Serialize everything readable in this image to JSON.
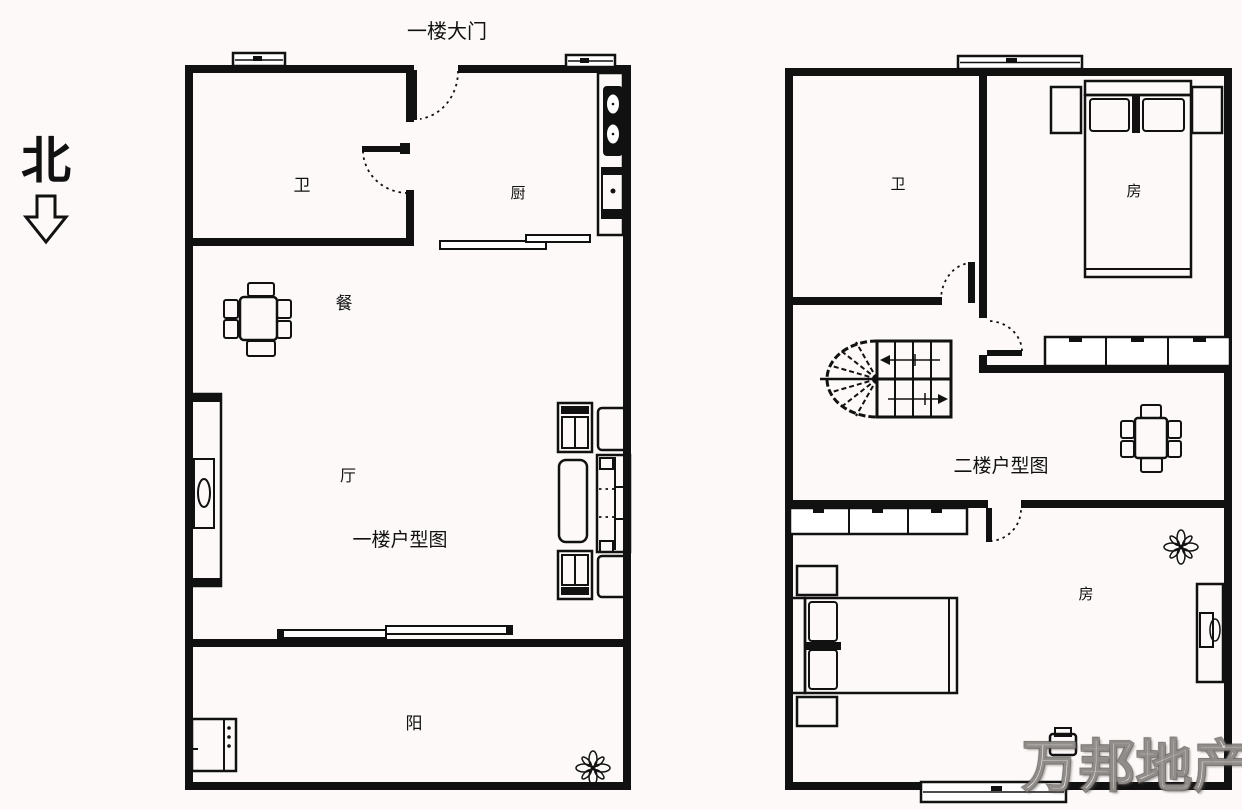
{
  "page": {
    "background": "#fcf9f8",
    "line_color": "#111111",
    "watermark_color": "#b9b3ae"
  },
  "north_indicator": {
    "label": "北"
  },
  "entrance": {
    "label": "一楼大门"
  },
  "floor1": {
    "title": "一楼户型图",
    "rooms": {
      "bathroom": "卫",
      "kitchen": "厨",
      "dining": "餐",
      "living": "厅",
      "balcony": "阳"
    }
  },
  "floor2": {
    "title": "二楼户型图",
    "rooms": {
      "bathroom": "卫",
      "bedroom_top": "房",
      "bedroom_bottom": "房"
    }
  },
  "watermark": {
    "text": "万邦地产"
  }
}
